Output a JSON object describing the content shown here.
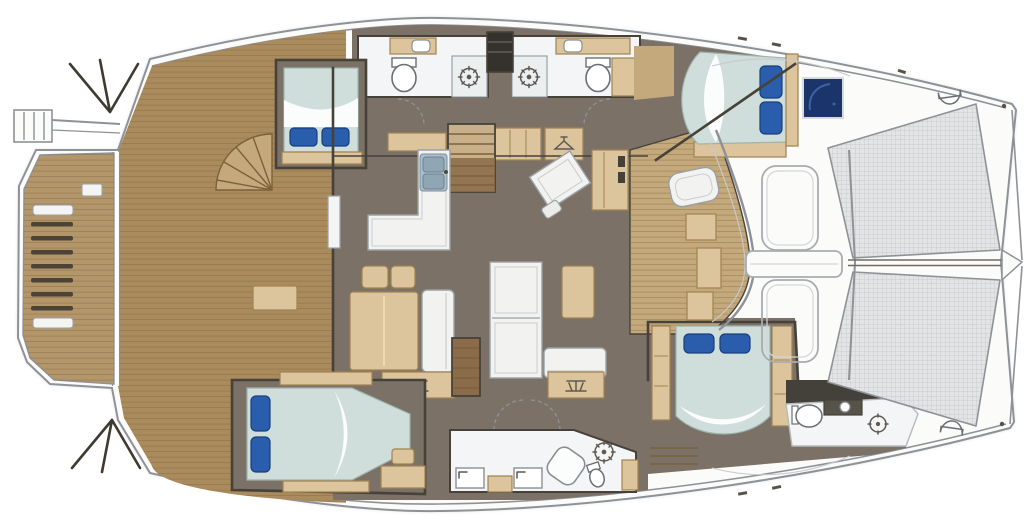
{
  "meta": {
    "title": "Catamaran yacht deck and accommodation floor plan, bow facing right",
    "figure_type": "boat-floor-plan",
    "orientation": "bow-right-stern-left"
  },
  "palette": {
    "hull": "#fbfbfa",
    "outline": "#8e9297",
    "deck_line": "#c7cacc",
    "shadow": "#d6d9db",
    "teak": "#a98b5d",
    "teak_light": "#b3966a",
    "teak_pale": "#c4a97c",
    "teak_line": "#7e6138",
    "fan_line": "#3f3a31",
    "interior": "#7b7166",
    "wall": "#46423a",
    "tan": "#dcc49c",
    "tan_border": "#a08352",
    "white_furniture": "#f2f2f1",
    "furn_border": "#9aa1a6",
    "bathroom": "#f4f5f6",
    "bed": "#cfdeda",
    "bed_sheet": "#ffffff",
    "pillow": "#2a5dab",
    "pillow_dark": "#16407f",
    "hatch_navy": "#1b356b",
    "hatch_swirl": "#3c62a8",
    "tramp": "#e3e4e5",
    "tramp_grid": "#c0c3c5",
    "dark_area": "#44403a",
    "steel": "#aabfcb",
    "steel_border": "#7c8f9b",
    "door_arc": "#8d9196",
    "glyph": "#5d5952"
  },
  "rooms": {
    "swim_platform": {
      "label": "Swim platform with boarding ladder"
    },
    "aft_deck": {
      "label": "Aft cockpit teak deck"
    },
    "salon": {
      "label": "Main deck salon with dinette and sofas"
    },
    "galley": {
      "label": "Galley with double sink counter"
    },
    "port_hull": {
      "label": "Port hull: two heads with showers and companionway stairs"
    },
    "starboard_hull": {
      "label": "Starboard hull: owner bathroom with twin sinks and shower"
    },
    "cabin_aft_port": {
      "label": "Aft port double cabin"
    },
    "cabin_fwd_port": {
      "label": "Forward port double cabin"
    },
    "cabin_aft_stbd": {
      "label": "Aft starboard double cabin with desk"
    },
    "cabin_fwd_stbd": {
      "label": "Forward starboard double cabin"
    },
    "fwd_head": {
      "label": "Forward head with toilet and shower"
    },
    "fwd_cockpit": {
      "label": "Forward cockpit lounge"
    },
    "foredeck": {
      "label": "Foredeck with hatches and crossbeam"
    },
    "trampolines": {
      "label": "Twin bow trampolines with netting"
    }
  },
  "features": {
    "double_beds": 4,
    "toilets": 4,
    "shower_icons": 4,
    "sinks": 6,
    "staircases": 3,
    "trampoline_panels": 2,
    "deck_hatch_color": "navy-blue"
  }
}
